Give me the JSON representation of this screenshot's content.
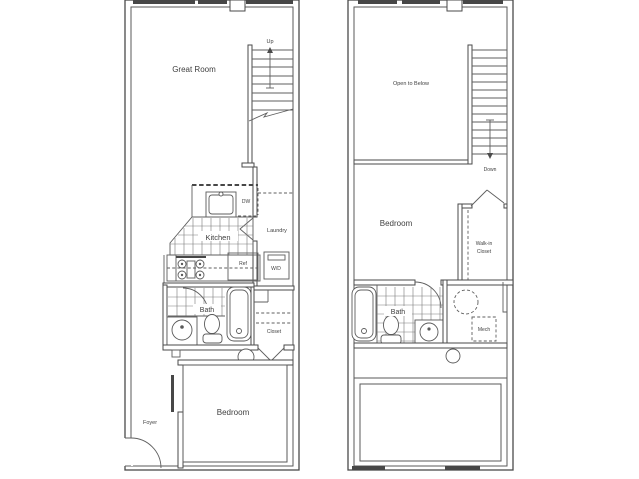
{
  "floor1": {
    "great_room": "Great Room",
    "up": "Up",
    "kitchen": "Kitchen",
    "dishwasher": "DW",
    "laundry": "Laundry",
    "refrigerator": "Ref",
    "washer_dryer": "W/D",
    "bath": "Bath",
    "closet": "Closet",
    "foyer": "Foyer",
    "bedroom": "Bedroom"
  },
  "floor2": {
    "open_to_below": "Open to Below",
    "down": "Down",
    "bedroom": "Bedroom",
    "walk_in_line1": "Walk-in",
    "walk_in_line2": "Closet",
    "bath": "Bath",
    "mech": "Mech"
  },
  "colors": {
    "wall": "#4a4a4a",
    "fixture": "#5a5a5a",
    "text": "#3f3f3f",
    "background": "#ffffff"
  }
}
